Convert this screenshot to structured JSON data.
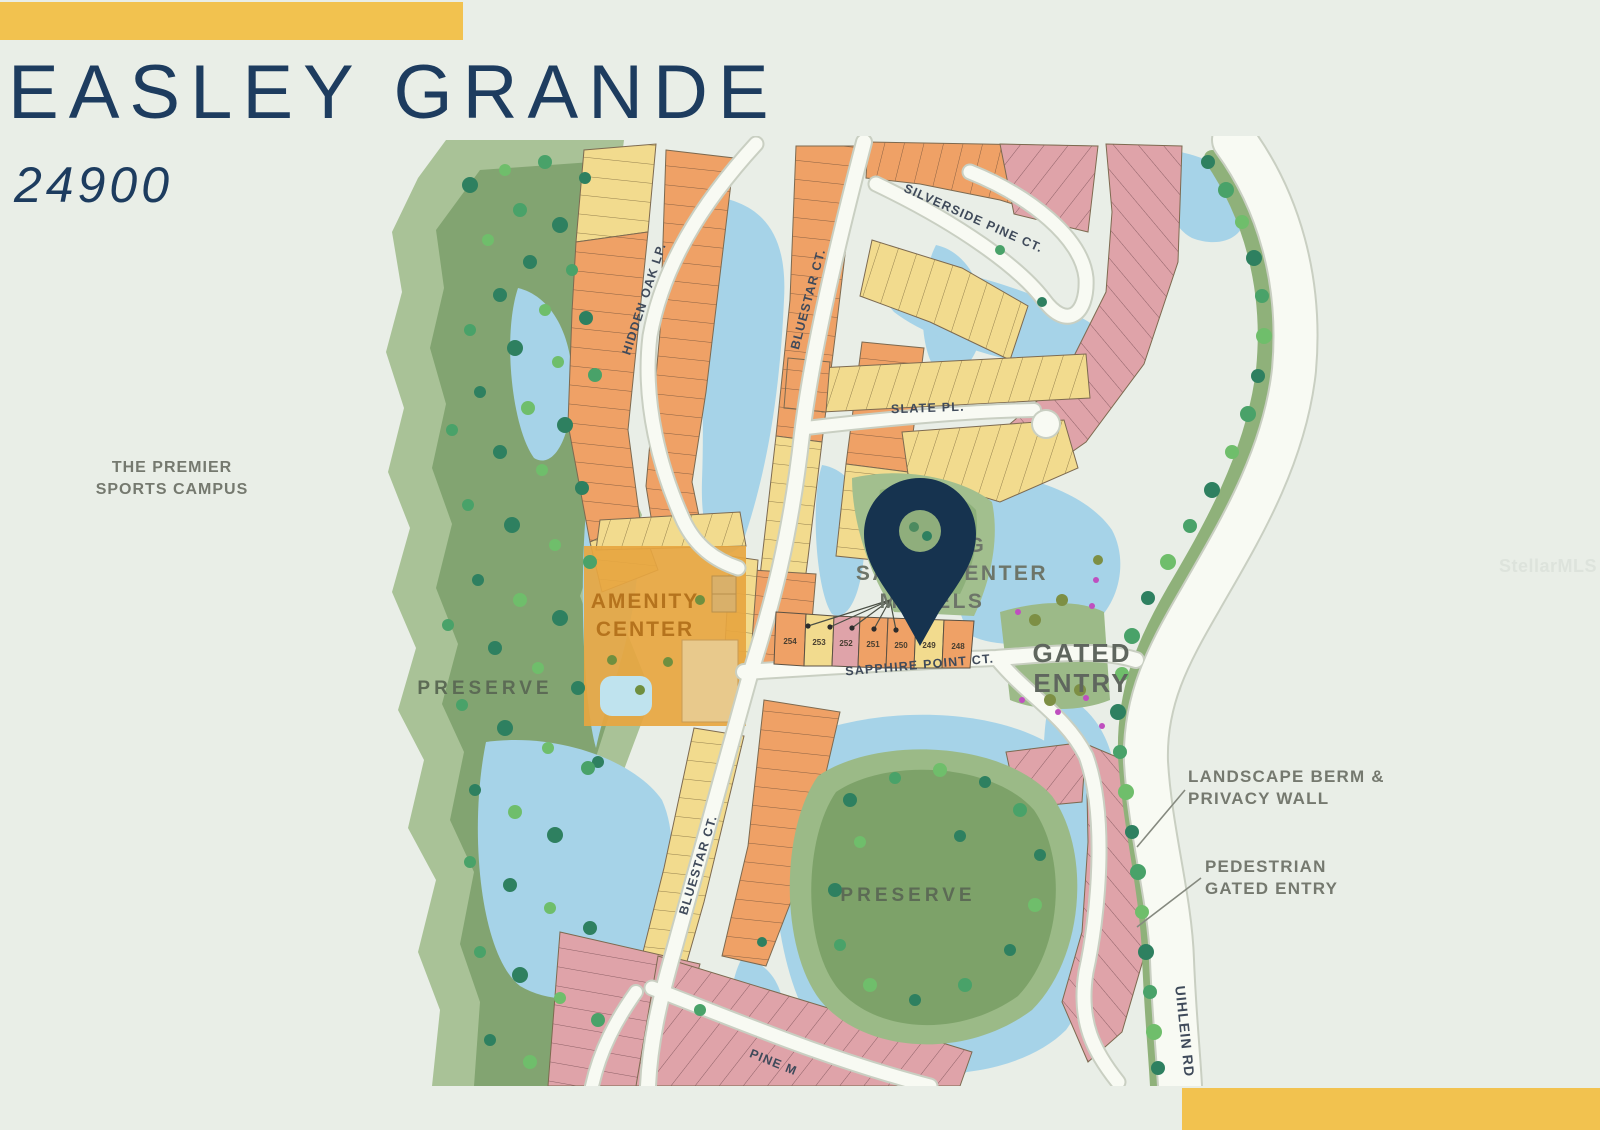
{
  "header": {
    "title": "EASLEY GRANDE",
    "subtitle": "24900"
  },
  "left_annotation": {
    "line1": "THE PREMIER",
    "line2": "SPORTS CAMPUS"
  },
  "right_annotations": {
    "landscape_berm_line1": "LANDSCAPE BERM &",
    "landscape_berm_line2": "PRIVACY WALL",
    "pedestrian_line1": "PEDESTRIAN",
    "pedestrian_line2": "GATED ENTRY"
  },
  "watermark": "StellarMLS",
  "map": {
    "streets": {
      "hidden_oak": "HIDDEN OAK LP.",
      "bluestar_upper": "BLUESTAR CT.",
      "bluestar_lower": "BLUESTAR CT.",
      "silverside": "SILVERSIDE PINE CT.",
      "slate": "SLATE PL.",
      "sapphire": "SAPPHIRE POINT CT.",
      "pine": "PINE M",
      "uihlein": "UIHLEIN RD"
    },
    "areas": {
      "preserve_left": "PRESERVE",
      "preserve_bottom": "PRESERVE",
      "amenity_line1": "AMENITY",
      "amenity_line2": "CENTER",
      "gated_entry_line1": "GATED",
      "gated_entry_line2": "ENTRY",
      "sales_center_line1": "PARKING",
      "sales_center_line2": "SALES CENTER",
      "sales_center_line3": "MODELS"
    },
    "model_lots": [
      "254",
      "253",
      "252",
      "251",
      "250",
      "249",
      "248"
    ],
    "colors": {
      "accent_yellow": "#f2c24f",
      "title_navy": "#1d3c5f",
      "lot_orange": "#efa166",
      "lot_yellow": "#f2db8e",
      "lot_pink": "#dfa3a9",
      "water": "#a6d3e8",
      "preserve_green": "#82a471",
      "pin_navy": "#16334f"
    }
  }
}
